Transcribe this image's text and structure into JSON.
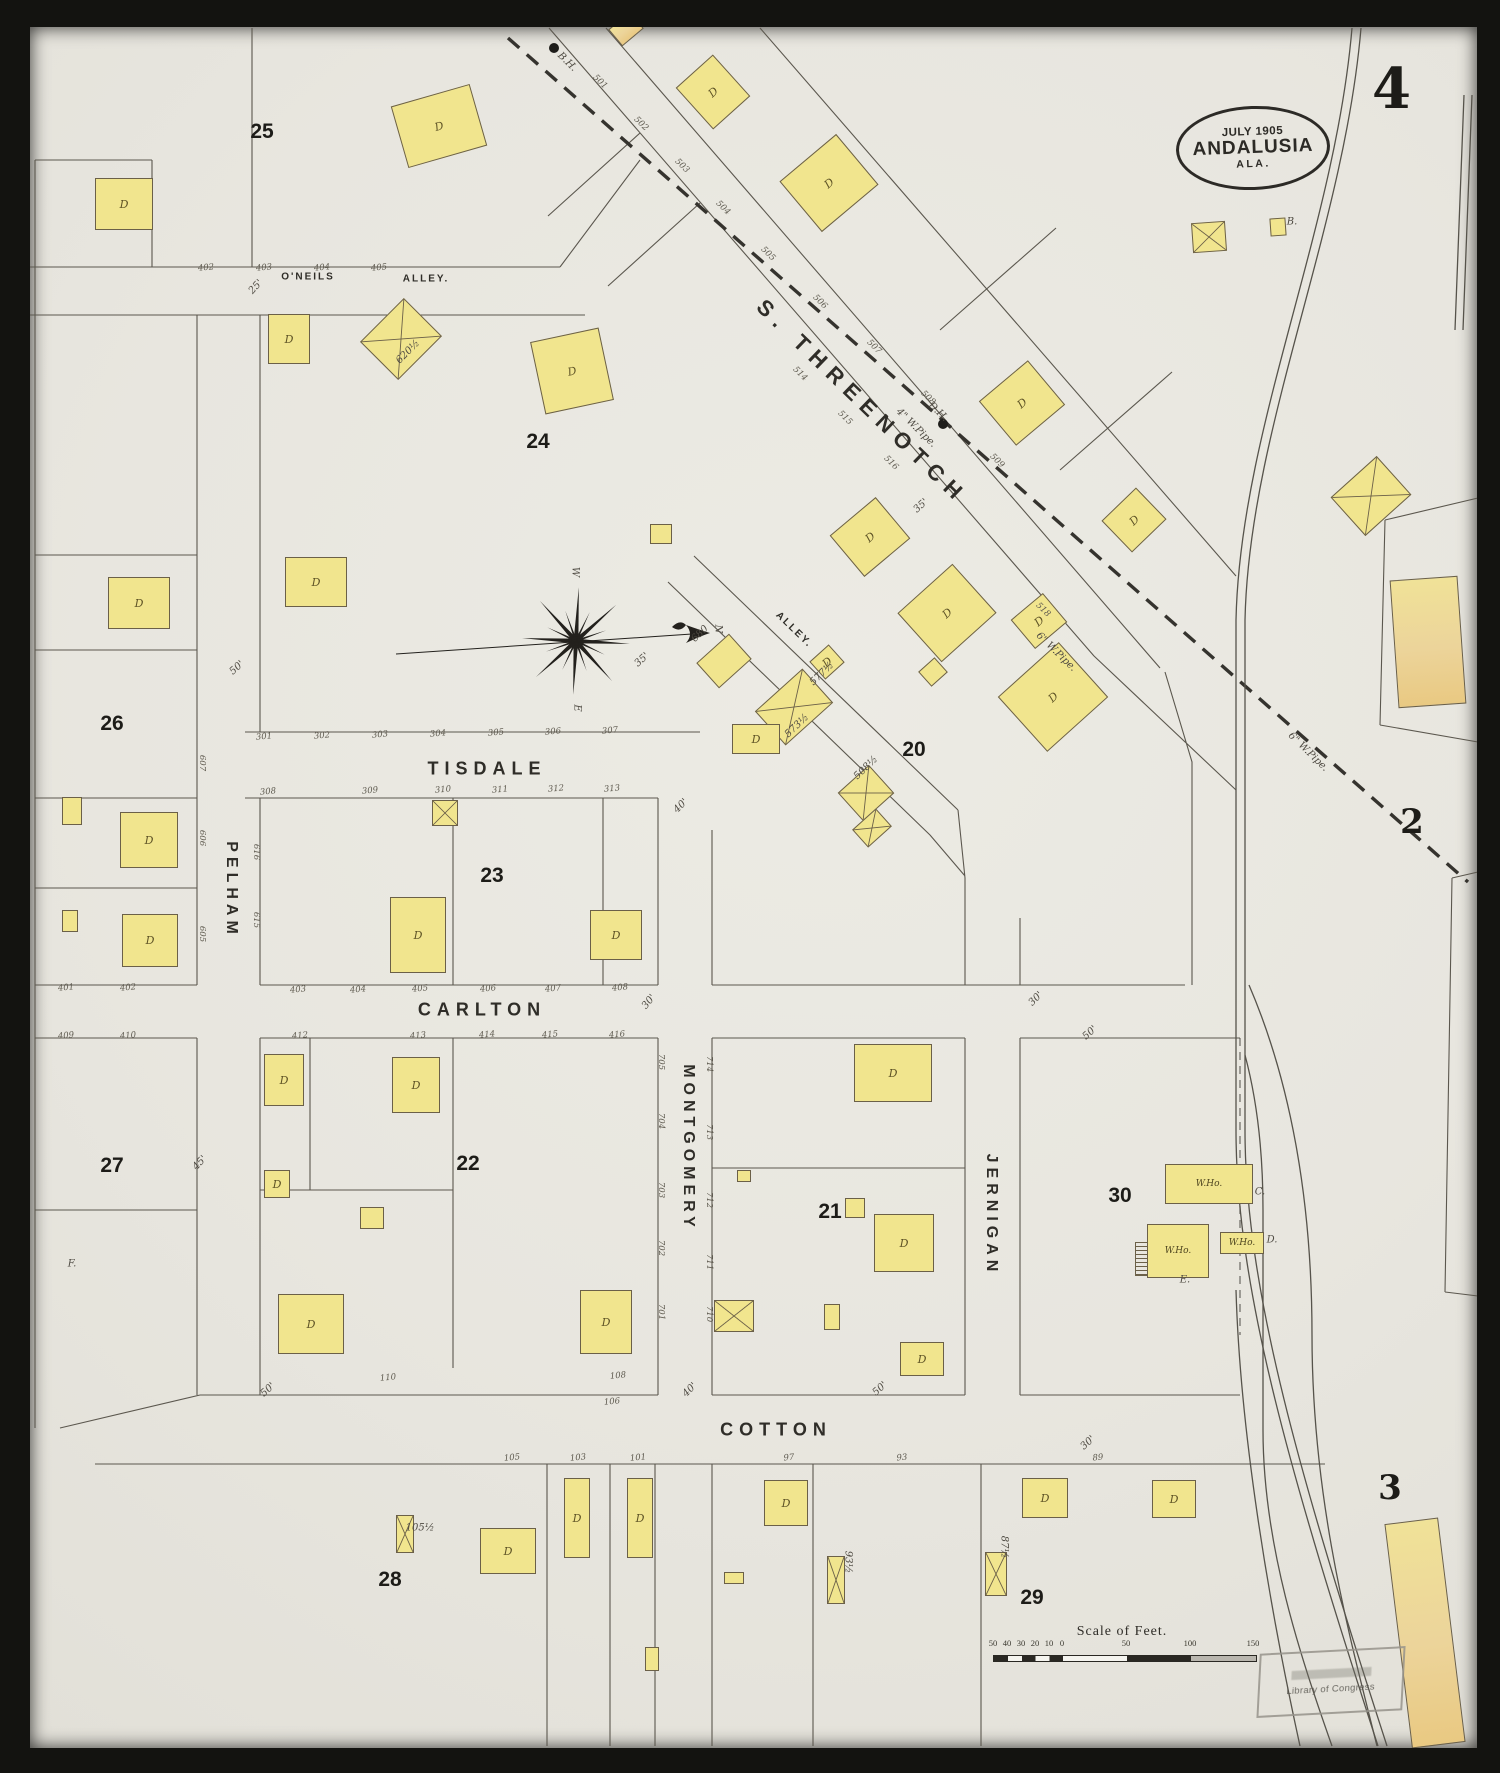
{
  "sheet": {
    "page_number": "4"
  },
  "title_oval": {
    "date": "JULY 1905",
    "city": "ANDALUSIA",
    "state": "ALA."
  },
  "colors": {
    "paper": "#e8e6df",
    "building_yellow": "#f1e58e",
    "building_tan": "#ecd49a",
    "line": "#5b574e",
    "ink": "#2c2a26"
  },
  "adjacent_sheets": [
    [
      "2",
      1412,
      822
    ],
    [
      "3",
      1390,
      1488
    ]
  ],
  "street_labels": [
    {
      "t": "S. THREENOTCH",
      "x": 862,
      "y": 402,
      "r": 44,
      "s": 22,
      "ls": 8
    },
    {
      "t": "TISDALE",
      "x": 487,
      "y": 769,
      "r": 0,
      "s": 18,
      "ls": 6
    },
    {
      "t": "CARLTON",
      "x": 482,
      "y": 1010,
      "r": 0,
      "s": 18,
      "ls": 6
    },
    {
      "t": "COTTON",
      "x": 776,
      "y": 1430,
      "r": 0,
      "s": 18,
      "ls": 6
    },
    {
      "t": "PELHAM",
      "x": 231,
      "y": 890,
      "r": 90,
      "s": 16,
      "ls": 5
    },
    {
      "t": "MONTGOMERY",
      "x": 688,
      "y": 1148,
      "r": 90,
      "s": 16,
      "ls": 5
    },
    {
      "t": "JERNIGAN",
      "x": 991,
      "y": 1215,
      "r": 90,
      "s": 16,
      "ls": 5
    },
    {
      "t": "O'NEILS",
      "x": 308,
      "y": 277,
      "r": 0,
      "s": 10,
      "ls": 2
    },
    {
      "t": "ALLEY.",
      "x": 426,
      "y": 279,
      "r": 0,
      "s": 10,
      "ls": 2
    },
    {
      "t": "ALLEY.",
      "x": 794,
      "y": 630,
      "r": 44,
      "s": 10,
      "ls": 2
    }
  ],
  "block_numbers": [
    [
      "25",
      262,
      132
    ],
    [
      "24",
      538,
      442
    ],
    [
      "26",
      112,
      724
    ],
    [
      "27",
      112,
      1166
    ],
    [
      "23",
      492,
      876
    ],
    [
      "22",
      468,
      1164
    ],
    [
      "21",
      830,
      1212
    ],
    [
      "20",
      914,
      750
    ],
    [
      "30",
      1120,
      1196
    ],
    [
      "28",
      390,
      1580
    ],
    [
      "29",
      1032,
      1598
    ]
  ],
  "house_numbers": [
    [
      "301",
      264,
      737,
      -5
    ],
    [
      "302",
      322,
      736,
      -5
    ],
    [
      "303",
      380,
      735,
      -5
    ],
    [
      "304",
      438,
      734,
      -5
    ],
    [
      "305",
      496,
      733,
      -5
    ],
    [
      "306",
      553,
      732,
      -5
    ],
    [
      "307",
      610,
      731,
      -5
    ],
    [
      "308",
      268,
      792,
      -5
    ],
    [
      "309",
      370,
      791,
      -5
    ],
    [
      "310",
      443,
      790,
      -5
    ],
    [
      "311",
      500,
      790,
      -5
    ],
    [
      "312",
      556,
      789,
      -5
    ],
    [
      "313",
      612,
      789,
      -5
    ],
    [
      "403",
      298,
      990,
      -5
    ],
    [
      "404",
      358,
      990,
      -5
    ],
    [
      "405",
      420,
      989,
      -5
    ],
    [
      "406",
      488,
      989,
      -5
    ],
    [
      "407",
      553,
      989,
      -5
    ],
    [
      "408",
      620,
      988,
      -5
    ],
    [
      "412",
      300,
      1036,
      -5
    ],
    [
      "413",
      418,
      1036,
      -5
    ],
    [
      "414",
      487,
      1035,
      -5
    ],
    [
      "415",
      550,
      1035,
      -5
    ],
    [
      "416",
      617,
      1035,
      -5
    ],
    [
      "401",
      66,
      988,
      -5
    ],
    [
      "402",
      128,
      988,
      -5
    ],
    [
      "409",
      66,
      1036,
      -5
    ],
    [
      "410",
      128,
      1036,
      -5
    ],
    [
      "106",
      612,
      1402,
      -5
    ],
    [
      "110",
      388,
      1378,
      -5
    ],
    [
      "108",
      618,
      1376,
      -5
    ],
    [
      "105",
      512,
      1458,
      -5
    ],
    [
      "103",
      578,
      1458,
      -5
    ],
    [
      "101",
      638,
      1458,
      -5
    ],
    [
      "97",
      789,
      1458,
      -5
    ],
    [
      "93",
      902,
      1458,
      -5
    ],
    [
      "89",
      1098,
      1458,
      -5
    ],
    [
      "402",
      206,
      268,
      -5
    ],
    [
      "403",
      264,
      268,
      -5
    ],
    [
      "404",
      322,
      268,
      -5
    ],
    [
      "405",
      379,
      268,
      -5
    ],
    [
      "607",
      202,
      763,
      90
    ],
    [
      "606",
      202,
      838,
      90
    ],
    [
      "605",
      202,
      934,
      90
    ],
    [
      "616",
      256,
      852,
      90
    ],
    [
      "615",
      256,
      920,
      90
    ],
    [
      "705",
      661,
      1062,
      90
    ],
    [
      "704",
      661,
      1121,
      90
    ],
    [
      "703",
      661,
      1190,
      90
    ],
    [
      "702",
      661,
      1248,
      90
    ],
    [
      "701",
      661,
      1312,
      90
    ],
    [
      "714",
      709,
      1064,
      90
    ],
    [
      "713",
      709,
      1132,
      90
    ],
    [
      "712",
      709,
      1200,
      90
    ],
    [
      "711",
      709,
      1262,
      90
    ],
    [
      "710",
      709,
      1314,
      90
    ],
    [
      "501",
      600,
      82,
      44
    ],
    [
      "502",
      641,
      124,
      44
    ],
    [
      "503",
      682,
      166,
      44
    ],
    [
      "504",
      723,
      208,
      44
    ],
    [
      "505",
      768,
      254,
      44
    ],
    [
      "506",
      820,
      302,
      44
    ],
    [
      "507",
      874,
      347,
      44
    ],
    [
      "508",
      928,
      398,
      44
    ],
    [
      "509",
      997,
      461,
      44
    ],
    [
      "514",
      800,
      374,
      44
    ],
    [
      "515",
      845,
      418,
      44
    ],
    [
      "516",
      891,
      463,
      44
    ],
    [
      "518",
      1043,
      610,
      44
    ]
  ],
  "annotations": [
    [
      "25'",
      256,
      287,
      -48
    ],
    [
      "50'",
      237,
      668,
      -42
    ],
    [
      "35'",
      921,
      506,
      -42
    ],
    [
      "35'",
      642,
      660,
      -42
    ],
    [
      "40'",
      681,
      806,
      -45
    ],
    [
      "30'",
      649,
      1002,
      -50
    ],
    [
      "30'",
      1036,
      999,
      -45
    ],
    [
      "45'",
      200,
      1163,
      -48
    ],
    [
      "50'",
      1090,
      1033,
      -42
    ],
    [
      "50'",
      880,
      1389,
      -42
    ],
    [
      "50'",
      268,
      1390,
      -42
    ],
    [
      "40'",
      690,
      1390,
      -45
    ],
    [
      "30'",
      1088,
      1443,
      -42
    ],
    [
      "4\" W.Pipe.",
      916,
      428,
      44
    ],
    [
      "6\" W.Pipe.",
      1056,
      652,
      44
    ],
    [
      "6\" W.Pipe.",
      1308,
      752,
      44
    ],
    [
      "B.H.",
      567,
      62,
      44
    ],
    [
      "D.H.",
      938,
      412,
      44
    ],
    [
      "620½",
      408,
      352,
      -45
    ],
    [
      "680",
      700,
      634,
      -44
    ],
    [
      "577½",
      822,
      674,
      -44
    ],
    [
      "573½",
      797,
      726,
      -44
    ],
    [
      "508½",
      866,
      768,
      -44
    ],
    [
      "105½",
      420,
      1528,
      0
    ],
    [
      "93½",
      848,
      1562,
      90
    ],
    [
      "87½",
      1004,
      1547,
      90
    ],
    [
      "B.",
      1292,
      222,
      0
    ],
    [
      "C.",
      1260,
      1192,
      0
    ],
    [
      "D.",
      1272,
      1240,
      0
    ],
    [
      "E.",
      1185,
      1280,
      0
    ],
    [
      "F.",
      72,
      1264,
      0
    ],
    [
      "N",
      718,
      629,
      90
    ],
    [
      "W",
      575,
      572,
      90
    ],
    [
      "E",
      577,
      708,
      90
    ]
  ],
  "buildings": [
    [
      95,
      178,
      58,
      52,
      0,
      "D",
      "y"
    ],
    [
      398,
      94,
      82,
      64,
      -16,
      "D",
      "y"
    ],
    [
      688,
      64,
      50,
      56,
      -42,
      "D",
      "y"
    ],
    [
      792,
      150,
      74,
      66,
      -40,
      "D",
      "y"
    ],
    [
      612,
      18,
      28,
      22,
      -40,
      "",
      "t"
    ],
    [
      1192,
      222,
      34,
      30,
      -4,
      "X",
      "y"
    ],
    [
      1270,
      218,
      16,
      18,
      -4,
      "",
      "y"
    ],
    [
      990,
      374,
      64,
      58,
      -40,
      "D",
      "y"
    ],
    [
      1110,
      498,
      48,
      44,
      -44,
      "D",
      "y"
    ],
    [
      1340,
      470,
      62,
      52,
      -42,
      "X",
      "y"
    ],
    [
      1394,
      578,
      68,
      128,
      -4,
      "",
      "t"
    ],
    [
      268,
      314,
      42,
      50,
      0,
      "D",
      "y"
    ],
    [
      370,
      312,
      62,
      54,
      -45,
      "X",
      "y"
    ],
    [
      537,
      334,
      70,
      74,
      -12,
      "D",
      "y"
    ],
    [
      285,
      557,
      62,
      50,
      0,
      "D",
      "y"
    ],
    [
      650,
      524,
      22,
      20,
      0,
      "",
      "y"
    ],
    [
      702,
      644,
      44,
      34,
      -42,
      "",
      "y"
    ],
    [
      910,
      580,
      74,
      66,
      -42,
      "D",
      "y"
    ],
    [
      840,
      510,
      60,
      54,
      -40,
      "D",
      "y"
    ],
    [
      1018,
      602,
      42,
      38,
      -40,
      "D",
      "y"
    ],
    [
      922,
      662,
      22,
      20,
      -42,
      "",
      "y"
    ],
    [
      814,
      650,
      26,
      24,
      -42,
      "D",
      "y"
    ],
    [
      762,
      684,
      64,
      46,
      -42,
      "X",
      "y"
    ],
    [
      1012,
      660,
      82,
      74,
      -42,
      "D",
      "y"
    ],
    [
      845,
      774,
      42,
      38,
      -42,
      "X",
      "y"
    ],
    [
      856,
      816,
      32,
      24,
      -42,
      "X",
      "y"
    ],
    [
      732,
      724,
      48,
      30,
      0,
      "D",
      "y"
    ],
    [
      108,
      577,
      62,
      52,
      0,
      "D",
      "y"
    ],
    [
      120,
      812,
      58,
      56,
      0,
      "D",
      "y"
    ],
    [
      122,
      914,
      56,
      53,
      0,
      "D",
      "y"
    ],
    [
      62,
      797,
      20,
      28,
      0,
      "",
      "y"
    ],
    [
      62,
      910,
      16,
      22,
      0,
      "",
      "y"
    ],
    [
      432,
      800,
      26,
      26,
      0,
      "X",
      "y"
    ],
    [
      390,
      897,
      56,
      76,
      0,
      "D",
      "y"
    ],
    [
      590,
      910,
      52,
      50,
      0,
      "D",
      "y"
    ],
    [
      264,
      1054,
      40,
      52,
      0,
      "D",
      "y"
    ],
    [
      392,
      1057,
      48,
      56,
      0,
      "D",
      "y"
    ],
    [
      264,
      1170,
      26,
      28,
      0,
      "D",
      "y"
    ],
    [
      360,
      1207,
      24,
      22,
      0,
      "",
      "y"
    ],
    [
      278,
      1294,
      66,
      60,
      0,
      "D",
      "y"
    ],
    [
      580,
      1290,
      52,
      64,
      0,
      "D",
      "y"
    ],
    [
      854,
      1044,
      78,
      58,
      0,
      "D",
      "y"
    ],
    [
      845,
      1198,
      20,
      20,
      0,
      "",
      "y"
    ],
    [
      874,
      1214,
      60,
      58,
      0,
      "D",
      "y"
    ],
    [
      714,
      1300,
      40,
      32,
      0,
      "X",
      "y"
    ],
    [
      824,
      1304,
      16,
      26,
      0,
      "",
      "y"
    ],
    [
      900,
      1342,
      44,
      34,
      0,
      "D",
      "y"
    ],
    [
      737,
      1170,
      14,
      12,
      0,
      "",
      "y"
    ],
    [
      1165,
      1164,
      88,
      40,
      0,
      "W",
      "y"
    ],
    [
      1147,
      1224,
      62,
      54,
      0,
      "W",
      "y"
    ],
    [
      1220,
      1232,
      44,
      22,
      0,
      "W",
      "y"
    ],
    [
      396,
      1515,
      18,
      38,
      0,
      "X",
      "y"
    ],
    [
      480,
      1528,
      56,
      46,
      0,
      "D",
      "y"
    ],
    [
      564,
      1478,
      26,
      80,
      0,
      "D",
      "y"
    ],
    [
      627,
      1478,
      26,
      80,
      0,
      "D",
      "y"
    ],
    [
      645,
      1647,
      14,
      24,
      0,
      "",
      "y"
    ],
    [
      724,
      1572,
      20,
      12,
      0,
      "",
      "y"
    ],
    [
      764,
      1480,
      44,
      46,
      0,
      "D",
      "y"
    ],
    [
      827,
      1556,
      18,
      48,
      0,
      "X",
      "y"
    ],
    [
      1022,
      1478,
      46,
      40,
      0,
      "D",
      "y"
    ],
    [
      1152,
      1480,
      44,
      38,
      0,
      "D",
      "y"
    ],
    [
      985,
      1552,
      22,
      44,
      0,
      "X",
      "y"
    ],
    [
      1398,
      1520,
      54,
      226,
      -7,
      "",
      "t"
    ]
  ],
  "building_marks": {
    "dwelling": "D",
    "warehouse": "W.Ho."
  },
  "compass": {
    "x": 576,
    "y": 641
  },
  "scale_bar": {
    "title": "Scale of Feet.",
    "ticks": [
      [
        "50",
        993
      ],
      [
        "40",
        1007
      ],
      [
        "30",
        1021
      ],
      [
        "20",
        1035
      ],
      [
        "10",
        1049
      ],
      [
        "0",
        1062
      ],
      [
        "50",
        1126
      ],
      [
        "100",
        1190
      ],
      [
        "150",
        1253
      ]
    ]
  },
  "stamp": {
    "text": "Library of Congress"
  }
}
